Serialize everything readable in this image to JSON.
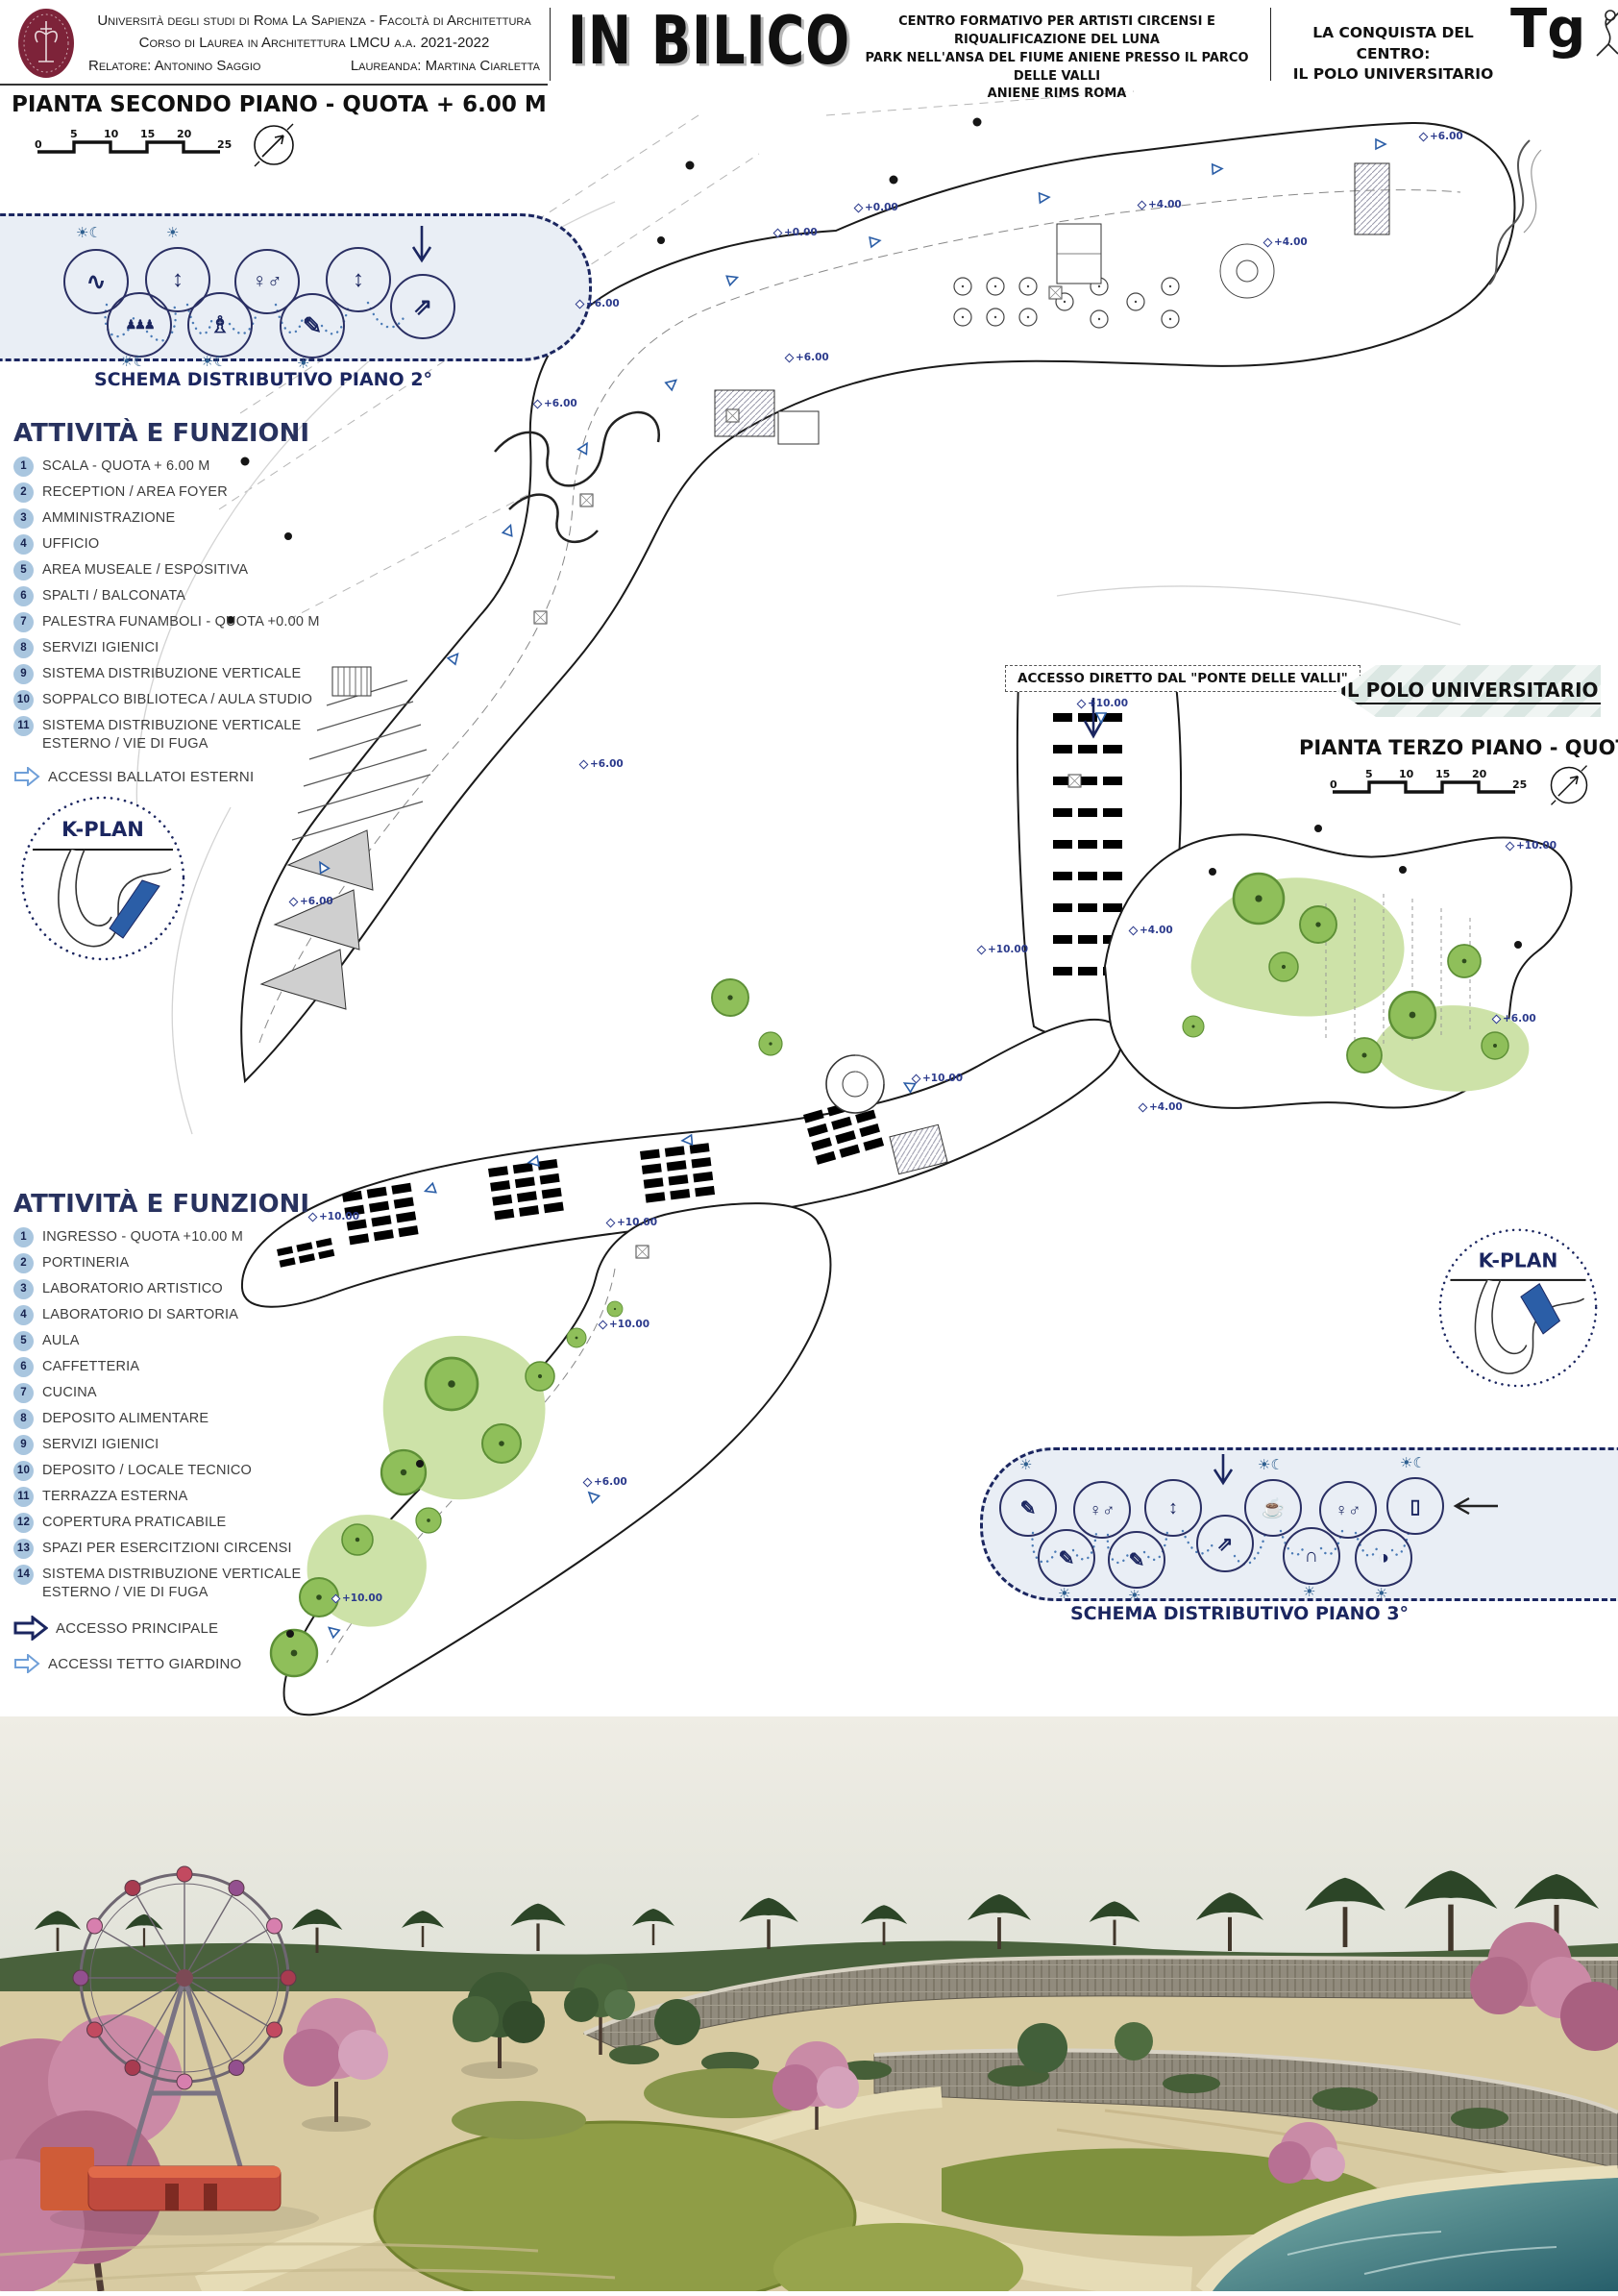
{
  "header": {
    "uni1": "Università degli studi di Roma La Sapienza - Facoltà di Architettura",
    "uni2": "Corso di Laurea in Architettura LMCU a.a. 2021-2022",
    "relatore": "Relatore: Antonino Saggio",
    "laureanda": "Laureanda: Martina Ciarletta",
    "title": "IN BILICO",
    "sub1": "CENTRO FORMATIVO PER ARTISTI CIRCENSI E RIQUALIFICAZIONE DEL LUNA",
    "sub2": "PARK NELL'ANSA DEL FIUME ANIENE PRESSO IL PARCO DELLE VALLI",
    "sub3": "ANIENE RIMS ROMA",
    "conquista1": "LA CONQUISTA DEL CENTRO:",
    "conquista2": "IL POLO UNIVERSITARIO",
    "tg": "Tg"
  },
  "plan2": {
    "title": "PIANTA SECONDO PIANO - QUOTA + 6.00 M",
    "scale": [
      "0",
      "5",
      "10",
      "15",
      "20",
      "25"
    ],
    "schema_caption": "SCHEMA DISTRIBUTIVO PIANO 2°",
    "activities_title": "ATTIVITÀ E FUNZIONI",
    "kplan": "K-PLAN",
    "legend_ballatoi": "ACCESSI BALLATOI ESTERNI",
    "items": [
      {
        "n": "1",
        "t": "SCALA - QUOTA + 6.00 M"
      },
      {
        "n": "2",
        "t": "RECEPTION / AREA FOYER"
      },
      {
        "n": "3",
        "t": "AMMINISTRAZIONE"
      },
      {
        "n": "4",
        "t": "UFFICIO"
      },
      {
        "n": "5",
        "t": "AREA MUSEALE / ESPOSITIVA"
      },
      {
        "n": "6",
        "t": "SPALTI / BALCONATA"
      },
      {
        "n": "7",
        "t": "PALESTRA FUNAMBOLI - QUOTA +0.00 M"
      },
      {
        "n": "8",
        "t": "SERVIZI IGIENICI"
      },
      {
        "n": "9",
        "t": "SISTEMA DISTRIBUZIONE VERTICALE"
      },
      {
        "n": "10",
        "t": "SOPPALCO BIBLIOTECA / AULA STUDIO"
      },
      {
        "n": "11",
        "t": "SISTEMA DISTRIBUZIONE VERTICALE ESTERNO / VIE DI FUGA"
      }
    ]
  },
  "plan3": {
    "banner": "IL POLO UNIVERSITARIO",
    "title": "PIANTA TERZO PIANO - QUOTA + 10.00 M",
    "scale": [
      "0",
      "5",
      "10",
      "15",
      "20",
      "25"
    ],
    "access_note": "ACCESSO DIRETTO DAL \"PONTE DELLE VALLI\"",
    "schema_caption": "SCHEMA DISTRIBUTIVO PIANO 3°",
    "activities_title": "ATTIVITÀ E FUNZIONI",
    "kplan": "K-PLAN",
    "legend_main": "ACCESSO PRINCIPALE",
    "legend_roof": "ACCESSI TETTO GIARDINO",
    "items": [
      {
        "n": "1",
        "t": "INGRESSO - QUOTA +10.00 M"
      },
      {
        "n": "2",
        "t": "PORTINERIA"
      },
      {
        "n": "3",
        "t": "LABORATORIO ARTISTICO"
      },
      {
        "n": "4",
        "t": "LABORATORIO DI SARTORIA"
      },
      {
        "n": "5",
        "t": "AULA"
      },
      {
        "n": "6",
        "t": "CAFFETTERIA"
      },
      {
        "n": "7",
        "t": "CUCINA"
      },
      {
        "n": "8",
        "t": "DEPOSITO ALIMENTARE"
      },
      {
        "n": "9",
        "t": "SERVIZI IGIENICI"
      },
      {
        "n": "10",
        "t": "DEPOSITO / LOCALE TECNICO"
      },
      {
        "n": "11",
        "t": "TERRAZZA ESTERNA"
      },
      {
        "n": "12",
        "t": "COPERTURA PRATICABILE"
      },
      {
        "n": "13",
        "t": "SPAZI PER ESERCITZIONI CIRCENSI"
      },
      {
        "n": "14",
        "t": "SISTEMA DISTRIBUZIONE VERTICALE ESTERNO / VIE DI FUGA"
      }
    ]
  },
  "glyphs": {
    "sun": "☀",
    "sun_moon": "☀☾",
    "hammock": "∿",
    "audience": "♟♟♟",
    "elevator": "↕",
    "statue": "♗",
    "wc": "♀♂",
    "document": "✎",
    "stairs": "⇗",
    "notebook": "✎",
    "coffee": "☕",
    "hanger": "∩",
    "palette": "◑",
    "door": "▯"
  },
  "elev": [
    "+6.00",
    "+0.00",
    "+0.00",
    "+4.00",
    "+4.00",
    "+6.00",
    "+6.00",
    "+6.00",
    "+6.00",
    "+6.00",
    "+10.00",
    "+10.00",
    "+10.00",
    "+4.00",
    "+10.00",
    "+6.00",
    "+4.00",
    "+10.00",
    "+10.00",
    "+10.00",
    "+6.00",
    "+10.00"
  ]
}
